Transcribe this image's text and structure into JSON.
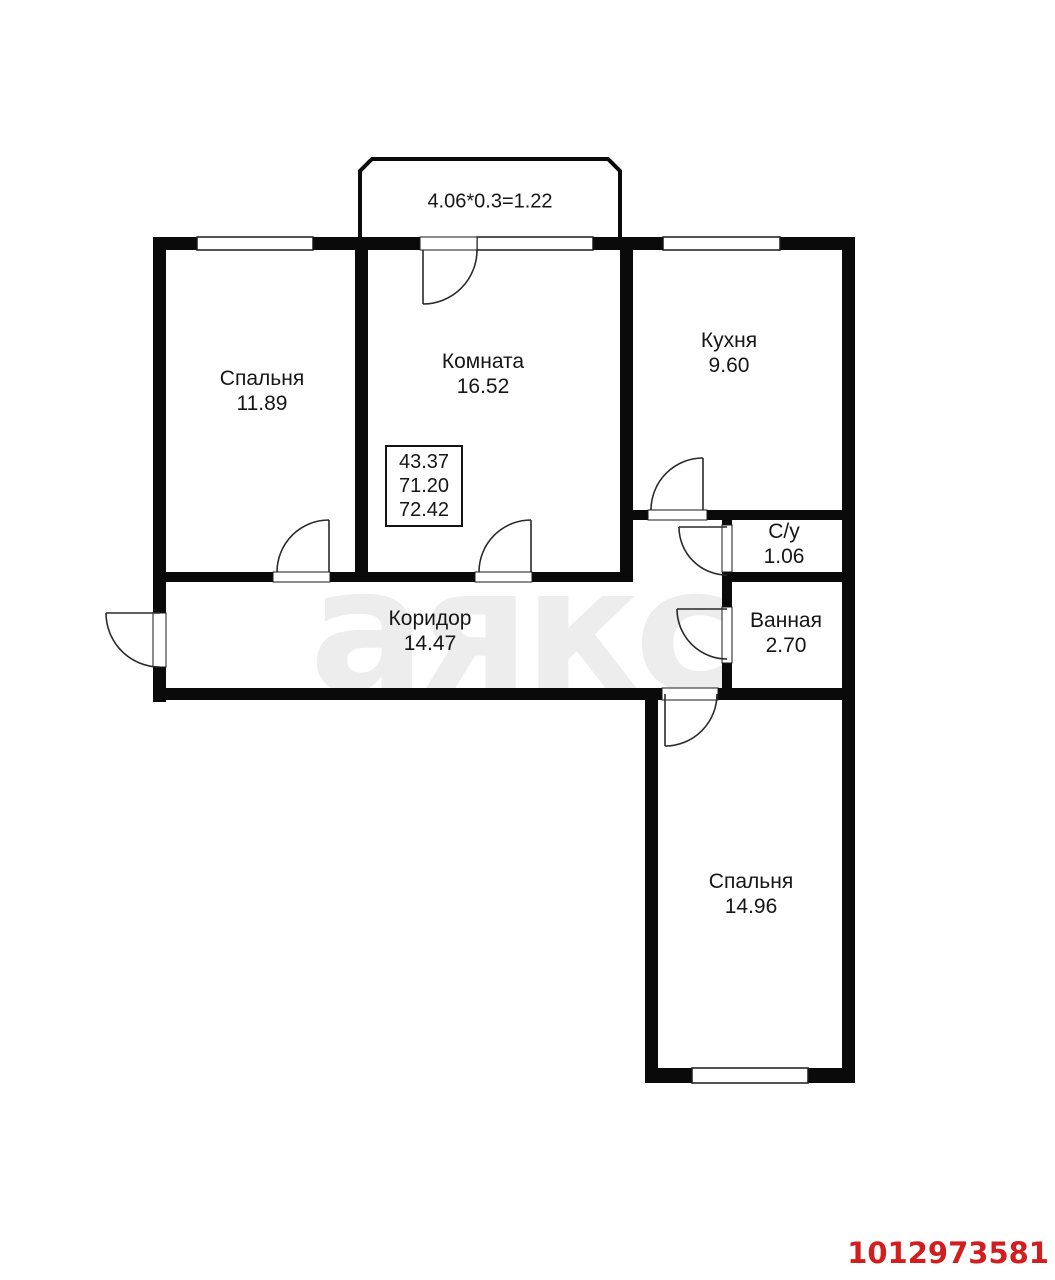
{
  "floorplan": {
    "balcony_dim_label": "4.06*0.3=1.22",
    "rooms": {
      "bedroom1": {
        "name": "Спальня",
        "area": "11.89"
      },
      "living_room": {
        "name": "Комната",
        "area": "16.52"
      },
      "kitchen": {
        "name": "Кухня",
        "area": "9.60"
      },
      "wc": {
        "name": "С/у",
        "area": "1.06"
      },
      "bathroom": {
        "name": "Ванная",
        "area": "2.70"
      },
      "corridor": {
        "name": "Коридор",
        "area": "14.47"
      },
      "bedroom2": {
        "name": "Спальня",
        "area": "14.96"
      }
    },
    "area_summary": {
      "values": [
        "43.37",
        "71.20",
        "72.42"
      ]
    },
    "watermark_text": "аякс",
    "listing_id": "1012973581",
    "colors": {
      "wall_black": "#0a0a0a",
      "listing_id_red": "#d21e1e",
      "watermark_gray": "#ededed"
    }
  }
}
